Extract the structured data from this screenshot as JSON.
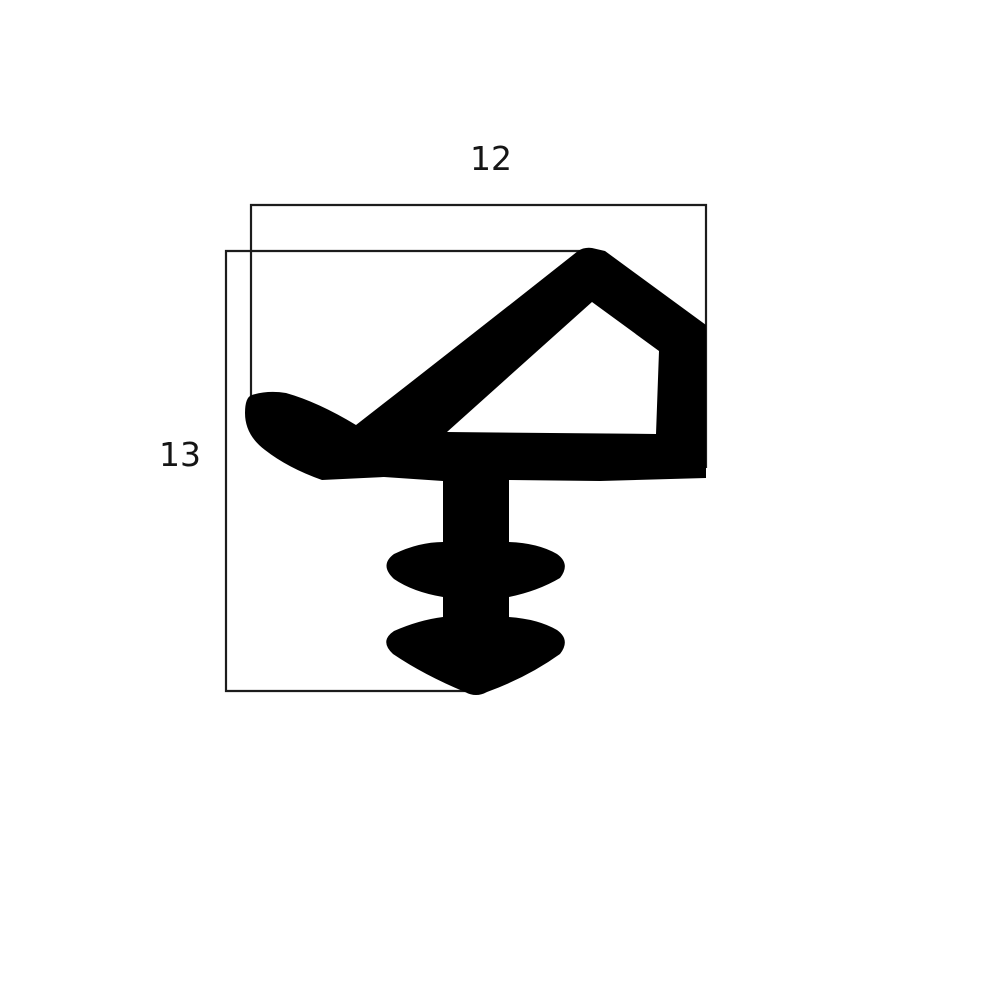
{
  "diagram": {
    "kind": "seal-profile-cross-section",
    "labels": {
      "width": "12",
      "height": "13"
    },
    "colors": {
      "background": "#ffffff",
      "shape": "#000000",
      "dimension_line": "#1c1c1c",
      "text": "#151515"
    }
  }
}
